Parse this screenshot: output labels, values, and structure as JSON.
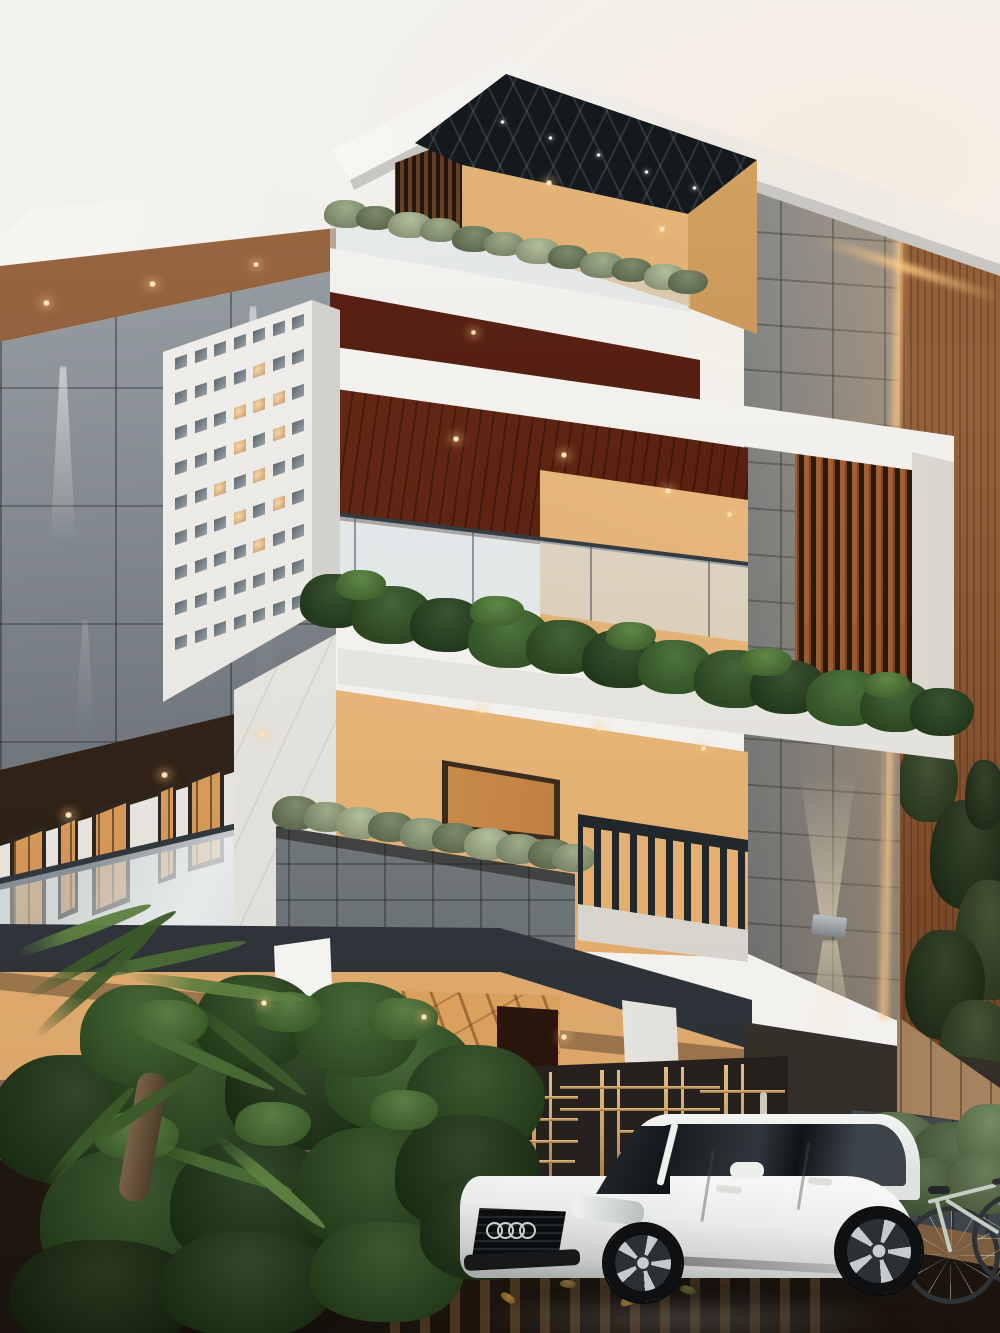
{
  "scene": {
    "type": "architectural exterior render",
    "setting": "modern three-storey residence at dusk with wet driveway",
    "objects": [
      "sky",
      "left wing with gray metal cladding and wall washer lights",
      "perforated white facade panel with lit square openings",
      "rooftop terrace with dark coffered pergola and tan wall",
      "vertical timber slat screens",
      "granite block feature column with LED edge glow and up-down sconce",
      "timber plank side wall with climbing vines",
      "cantilevered white frame balcony with dark timber ceiling, glass railing and hedge planter",
      "second floor with warm lit windows, glass railing, granite planter with grasses and dark baluster railing",
      "ground floor porch with white columns, veined marble wall, dark door and red accent",
      "front fence and entry gate with brass bars",
      "pale stone curb",
      "wet pavement with fallen leaves and reflections",
      "garden palms and shrubs",
      "white sedan with four-ring grille badge and five-spoke wheels",
      "bicycle leaning at right"
    ]
  },
  "palette": {
    "sky": "#f2f1ee",
    "slabWhite": "#f7f6f3",
    "slabShade": "#c9c7c1",
    "grayTop": "#aab1b5",
    "grayBot": "#474e54",
    "soffit1": "#a06c45",
    "soffit2": "#6d4428",
    "pergola": "#14191d",
    "tan1": "#ecbf83",
    "tan2": "#c4884b",
    "slatA": "#a75f33",
    "slatB": "#7c4526",
    "slatGap": "#2b1b10",
    "wood1": "#96633c",
    "wood2": "#5e3a20",
    "gran1": "#878d90",
    "gran2": "#565d61",
    "led": "#ffcf96",
    "maroon1": "#72301b",
    "maroon2": "#471507",
    "peach1": "#eec28a",
    "peach2": "#d99f60",
    "glassA": "#e8eef0",
    "glassB": "#aebcc2",
    "railDark": "#22272b",
    "marbleW": "#efeeea",
    "marbleB": "#d9a05e",
    "fence1": "#7a6752",
    "fence2": "#3f352c",
    "fr1": "#646c73",
    "fr2": "#3a4147",
    "gate": "#241f1c",
    "brass": "#c9a066",
    "curb1": "#dfcfa9",
    "curb2": "#c2b089",
    "gnd1": "#6b5136",
    "gnd2": "#1b140e",
    "carW": "#f2f4f2",
    "carShade": "#a9ada9",
    "cg1": "#14181b",
    "cg2": "#3c444a",
    "g1": "#93a37d",
    "g2": "#6f7f5c",
    "g3": "#a9b890",
    "h1": "#24401b",
    "h2": "#2f5222",
    "h3": "#3a6429",
    "hl": "#4d7a33",
    "gd1": "#1b3212",
    "gd2": "#27451a",
    "gd3": "#335723",
    "gdh": "#477030",
    "gdd": "#122208",
    "r1": "#5a7048",
    "r2": "#48603a",
    "r3": "#658052",
    "v1": "#2e401f",
    "v2": "#1f2f14",
    "l1": "#b98a2e",
    "l2": "#8a682a",
    "l3": "#76802f",
    "l4": "#a07426",
    "f1": "#4a6b34",
    "f2": "#3c5a29",
    "f3": "#5d7f40",
    "bike": "#c3cdc4"
  },
  "perforated_panel": {
    "cols": 7,
    "rows": 9,
    "pitch_x": 19.5,
    "pitch_y": 35,
    "offset_x": 5,
    "offset_y": 6,
    "lit": [
      [
        1,
        4
      ],
      [
        2,
        3
      ],
      [
        2,
        4
      ],
      [
        2,
        5
      ],
      [
        3,
        3
      ],
      [
        3,
        5
      ],
      [
        4,
        2
      ],
      [
        4,
        4
      ],
      [
        5,
        3
      ],
      [
        5,
        5
      ],
      [
        6,
        4
      ]
    ]
  },
  "gate": {
    "vbars": [
      [
        475,
        1075,
        130,
        3
      ],
      [
        492,
        1074,
        130,
        3
      ],
      [
        532,
        1073,
        133,
        4
      ],
      [
        549,
        1072,
        133,
        3
      ],
      [
        600,
        1070,
        138,
        4
      ],
      [
        617,
        1070,
        138,
        3
      ],
      [
        664,
        1067,
        142,
        4
      ],
      [
        681,
        1067,
        142,
        3
      ],
      [
        724,
        1065,
        146,
        4
      ],
      [
        741,
        1064,
        146,
        3
      ]
    ],
    "hbars": [
      [
        448,
        1096,
        130,
        3
      ],
      [
        448,
        1118,
        130,
        3
      ],
      [
        448,
        1140,
        130,
        3
      ],
      [
        560,
        1086,
        160,
        3
      ],
      [
        560,
        1108,
        160,
        3
      ],
      [
        620,
        1130,
        160,
        3
      ],
      [
        620,
        1152,
        160,
        3
      ],
      [
        700,
        1090,
        85,
        3
      ],
      [
        455,
        1160,
        120,
        3
      ]
    ]
  },
  "lights": [
    [
      545,
      180,
      8,
      6,
      "w"
    ],
    [
      658,
      226,
      8,
      6,
      "w"
    ],
    [
      42,
      300,
      9,
      6,
      "w"
    ],
    [
      148,
      281,
      9,
      6,
      "w"
    ],
    [
      252,
      262,
      8,
      5,
      "w"
    ],
    [
      500,
      120,
      5,
      4,
      "c"
    ],
    [
      548,
      136,
      5,
      4,
      "c"
    ],
    [
      596,
      153,
      5,
      4,
      "c"
    ],
    [
      644,
      170,
      5,
      4,
      "c"
    ],
    [
      692,
      186,
      5,
      4,
      "c"
    ],
    [
      452,
      436,
      8,
      6,
      "w"
    ],
    [
      560,
      452,
      8,
      6,
      "w"
    ],
    [
      664,
      488,
      8,
      6,
      "w"
    ],
    [
      726,
      512,
      7,
      5,
      "w"
    ],
    [
      470,
      330,
      7,
      5,
      "w"
    ],
    [
      64,
      812,
      9,
      6,
      "w"
    ],
    [
      160,
      772,
      9,
      6,
      "w"
    ],
    [
      258,
      732,
      8,
      5,
      "w"
    ],
    [
      478,
      708,
      7,
      5,
      "w"
    ],
    [
      596,
      726,
      7,
      5,
      "w"
    ],
    [
      700,
      746,
      7,
      5,
      "w"
    ],
    [
      260,
      1000,
      8,
      6,
      "w"
    ],
    [
      420,
      1014,
      8,
      6,
      "w"
    ],
    [
      560,
      1034,
      8,
      6,
      "w"
    ]
  ],
  "foliage": {
    "terrace": [
      [
        324,
        200,
        44,
        28,
        "g1"
      ],
      [
        356,
        206,
        40,
        24,
        "g2"
      ],
      [
        388,
        212,
        44,
        26,
        "g3"
      ],
      [
        420,
        218,
        40,
        24,
        "g1"
      ],
      [
        452,
        226,
        44,
        26,
        "g2"
      ],
      [
        484,
        232,
        40,
        24,
        "g1"
      ],
      [
        516,
        238,
        44,
        26,
        "g3"
      ],
      [
        548,
        245,
        40,
        24,
        "g2"
      ],
      [
        580,
        252,
        44,
        26,
        "g1"
      ],
      [
        612,
        258,
        40,
        24,
        "g2"
      ],
      [
        644,
        264,
        42,
        26,
        "g3"
      ],
      [
        668,
        270,
        40,
        24,
        "g2"
      ]
    ],
    "planter": [
      [
        272,
        796,
        48,
        34,
        "g2"
      ],
      [
        304,
        802,
        46,
        30,
        "g1"
      ],
      [
        336,
        807,
        48,
        32,
        "g3"
      ],
      [
        368,
        812,
        46,
        30,
        "g2"
      ],
      [
        400,
        818,
        48,
        32,
        "g1"
      ],
      [
        432,
        823,
        46,
        30,
        "g2"
      ],
      [
        464,
        828,
        48,
        32,
        "g3"
      ],
      [
        496,
        834,
        46,
        30,
        "g1"
      ],
      [
        528,
        839,
        46,
        30,
        "g2"
      ],
      [
        552,
        844,
        44,
        28,
        "g1"
      ]
    ],
    "hedge": [
      [
        300,
        574,
        70,
        54,
        "h1"
      ],
      [
        352,
        586,
        80,
        58,
        "h2"
      ],
      [
        410,
        598,
        74,
        54,
        "h1"
      ],
      [
        468,
        608,
        82,
        60,
        "h3"
      ],
      [
        526,
        620,
        76,
        54,
        "h2"
      ],
      [
        582,
        630,
        80,
        58,
        "h1"
      ],
      [
        638,
        640,
        74,
        54,
        "h3"
      ],
      [
        694,
        650,
        82,
        58,
        "h2"
      ],
      [
        750,
        660,
        76,
        54,
        "h1"
      ],
      [
        806,
        670,
        80,
        56,
        "h3"
      ],
      [
        860,
        680,
        72,
        52,
        "h2"
      ],
      [
        910,
        688,
        64,
        48,
        "h1"
      ],
      [
        336,
        570,
        50,
        30,
        "hl"
      ],
      [
        470,
        596,
        54,
        30,
        "hl"
      ],
      [
        606,
        622,
        50,
        28,
        "hl"
      ],
      [
        740,
        648,
        52,
        28,
        "hl"
      ],
      [
        864,
        672,
        46,
        26,
        "hl"
      ]
    ],
    "garden": [
      [
        -10,
        1055,
        170,
        130,
        "gd1"
      ],
      [
        110,
        1035,
        170,
        135,
        "gd2"
      ],
      [
        225,
        1025,
        160,
        125,
        "gd1"
      ],
      [
        325,
        1018,
        150,
        115,
        "gd3"
      ],
      [
        405,
        1045,
        140,
        110,
        "gd2"
      ],
      [
        40,
        1150,
        185,
        140,
        "gd2"
      ],
      [
        170,
        1140,
        170,
        130,
        "gd1"
      ],
      [
        295,
        1128,
        160,
        122,
        "gd2"
      ],
      [
        395,
        1115,
        145,
        115,
        "gd1"
      ],
      [
        10,
        1240,
        190,
        110,
        "gdd"
      ],
      [
        160,
        1232,
        175,
        105,
        "gd1"
      ],
      [
        310,
        1222,
        155,
        100,
        "gd2"
      ],
      [
        420,
        1175,
        125,
        105,
        "gd1"
      ],
      [
        80,
        985,
        130,
        100,
        "gd3"
      ],
      [
        195,
        975,
        120,
        92,
        "gd2"
      ],
      [
        295,
        982,
        125,
        95,
        "gd3"
      ],
      [
        128,
        1000,
        80,
        46,
        "gdh"
      ],
      [
        255,
        992,
        66,
        40,
        "gdh"
      ],
      [
        368,
        998,
        70,
        42,
        "gdh"
      ],
      [
        95,
        1112,
        84,
        48,
        "gdh"
      ],
      [
        235,
        1102,
        76,
        44,
        "gdh"
      ],
      [
        370,
        1090,
        68,
        40,
        "gdh"
      ]
    ],
    "right": [
      [
        852,
        1112,
        86,
        64,
        "r1"
      ],
      [
        908,
        1122,
        96,
        74,
        "r2"
      ],
      [
        956,
        1104,
        70,
        60,
        "r3"
      ],
      [
        884,
        1158,
        86,
        58,
        "r2"
      ],
      [
        946,
        1154,
        80,
        60,
        "r1"
      ],
      [
        836,
        1130,
        64,
        48,
        "r2"
      ]
    ],
    "vines": [
      [
        898,
        742,
        60,
        80,
        "v1"
      ],
      [
        930,
        800,
        80,
        110,
        "v2"
      ],
      [
        955,
        880,
        70,
        120,
        "v1"
      ],
      [
        905,
        930,
        80,
        110,
        "v2"
      ],
      [
        940,
        1000,
        75,
        90,
        "v1"
      ],
      [
        965,
        760,
        40,
        70,
        "v2"
      ]
    ],
    "leaves": [
      [
        60,
        1262,
        18,
        9,
        "l1",
        20
      ],
      [
        110,
        1280,
        16,
        8,
        "l2",
        -15
      ],
      [
        170,
        1268,
        18,
        8,
        "l4",
        40
      ],
      [
        230,
        1288,
        16,
        8,
        "l1",
        10
      ],
      [
        300,
        1272,
        18,
        9,
        "l3",
        -30
      ],
      [
        360,
        1290,
        16,
        8,
        "l2",
        25
      ],
      [
        430,
        1278,
        18,
        8,
        "l1",
        -10
      ],
      [
        500,
        1294,
        16,
        8,
        "l4",
        35
      ],
      [
        560,
        1280,
        16,
        8,
        "l2",
        5
      ],
      [
        620,
        1296,
        18,
        9,
        "l1",
        -25
      ],
      [
        680,
        1286,
        16,
        8,
        "l3",
        15
      ],
      [
        260,
        1308,
        16,
        8,
        "l2",
        30
      ],
      [
        140,
        1310,
        18,
        8,
        "l1",
        -20
      ],
      [
        390,
        1312,
        16,
        8,
        "l4",
        12
      ],
      [
        80,
        1240,
        14,
        7,
        "l3",
        0
      ],
      [
        330,
        1246,
        14,
        7,
        "l1",
        50
      ]
    ]
  },
  "fronds": [
    [
      20,
      995,
      180,
      -30,
      "f2"
    ],
    [
      60,
      975,
      190,
      -12,
      "f1"
    ],
    [
      120,
      968,
      185,
      8,
      "f3"
    ],
    [
      30,
      1035,
      170,
      -42,
      "f2"
    ],
    [
      110,
      1010,
      180,
      24,
      "f1"
    ],
    [
      180,
      990,
      160,
      38,
      "f2"
    ],
    [
      10,
      950,
      150,
      -20,
      "f3"
    ],
    [
      70,
      1150,
      150,
      -34,
      "f2"
    ],
    [
      140,
      1135,
      160,
      18,
      "f1"
    ],
    [
      40,
      1185,
      140,
      -48,
      "f2"
    ],
    [
      210,
      1125,
      150,
      40,
      "f3"
    ]
  ],
  "car": {
    "color": "white",
    "badge_rings": 4,
    "ring_positions": [
      486,
      497,
      508,
      519
    ],
    "ring_y": 1222
  }
}
